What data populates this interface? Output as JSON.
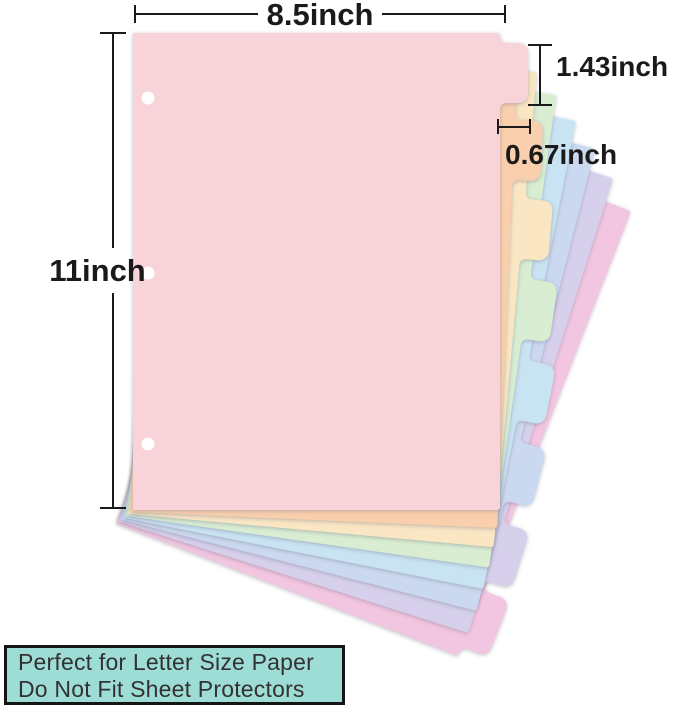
{
  "annotations": {
    "width_label": "8.5inch",
    "height_label": "11inch",
    "tab_height_label": "1.43inch",
    "tab_offset_label": "0.67inch"
  },
  "dividers": {
    "count": 8,
    "hole_count": 3,
    "hole_color": "#ffffff",
    "sheets": [
      {
        "name": "pink",
        "color": "#f8d4da"
      },
      {
        "name": "peach",
        "color": "#f9cfad"
      },
      {
        "name": "cream",
        "color": "#fae6c3"
      },
      {
        "name": "mint",
        "color": "#d8edd2"
      },
      {
        "name": "light-blue",
        "color": "#c8e3f2"
      },
      {
        "name": "periwinkle",
        "color": "#cbd9f0"
      },
      {
        "name": "lavender",
        "color": "#d6d0ec"
      },
      {
        "name": "magenta",
        "color": "#f2c5e0"
      }
    ]
  },
  "note": {
    "line1": "Perfect for Letter Size Paper",
    "line2": "Do Not Fit Sheet Protectors",
    "bg_color": "#9edcd6",
    "border_color": "#151515",
    "text_color": "#323232"
  },
  "dimension_color": "#1a1a1a"
}
